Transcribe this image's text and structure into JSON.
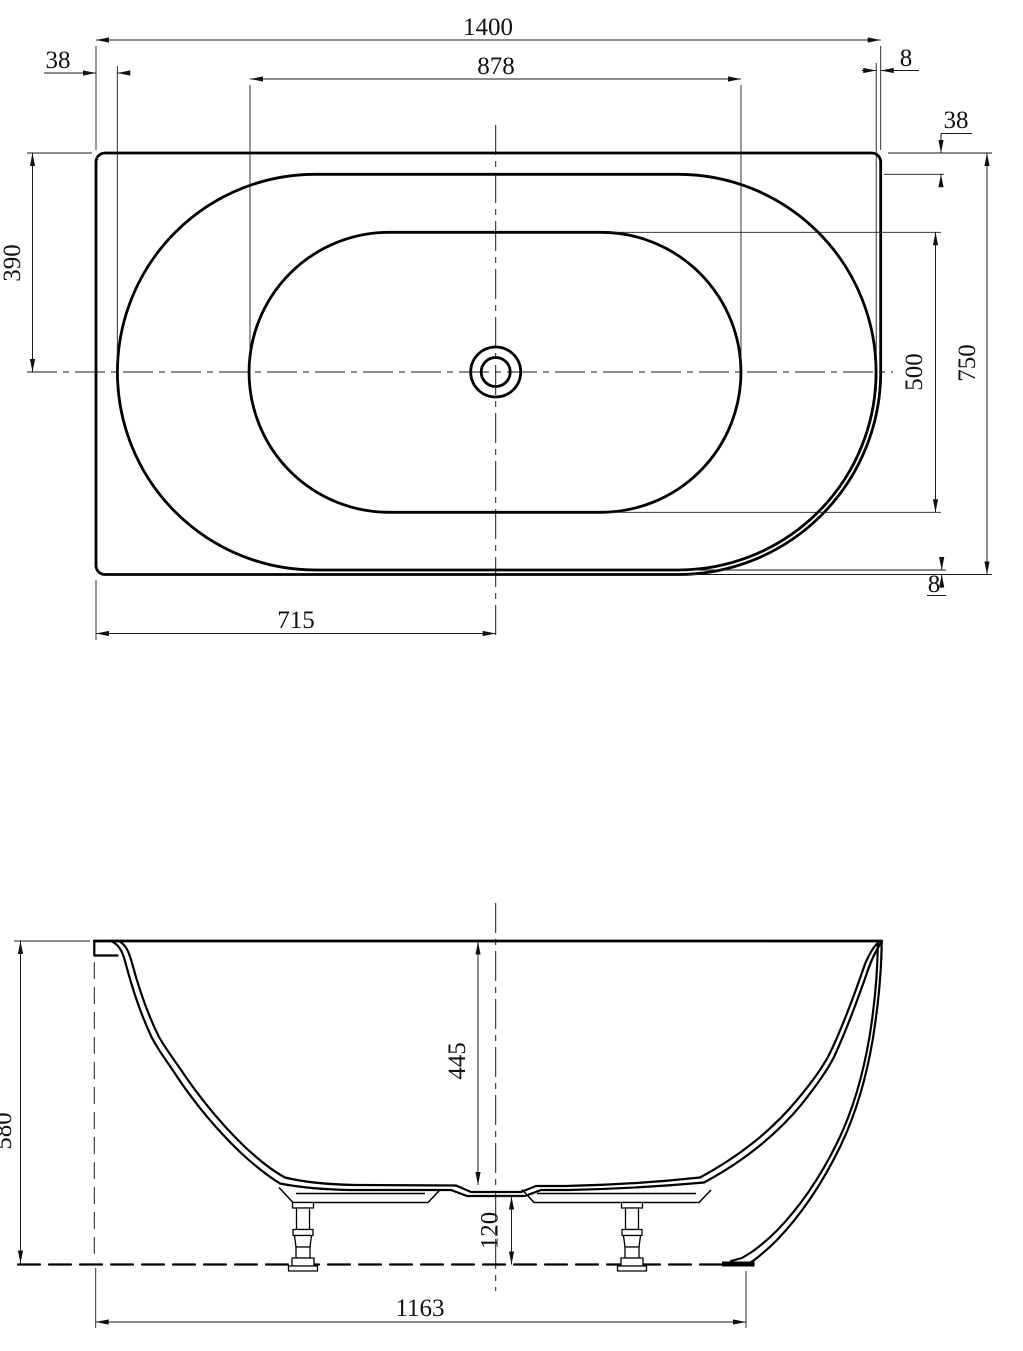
{
  "views": {
    "plan": {
      "dimensions": {
        "overall_width": "1400",
        "basin_width": "878",
        "rim_offset_left": "38",
        "rim_offset_right": "8",
        "rim_offset_top": "38",
        "overall_depth": "750",
        "basin_depth": "500",
        "rim_offset_bottom": "8",
        "center_from_top": "390",
        "center_from_left": "715"
      }
    },
    "side": {
      "dimensions": {
        "overall_height": "580",
        "inner_depth": "445",
        "base_clearance": "120",
        "base_length": "1163"
      }
    }
  }
}
